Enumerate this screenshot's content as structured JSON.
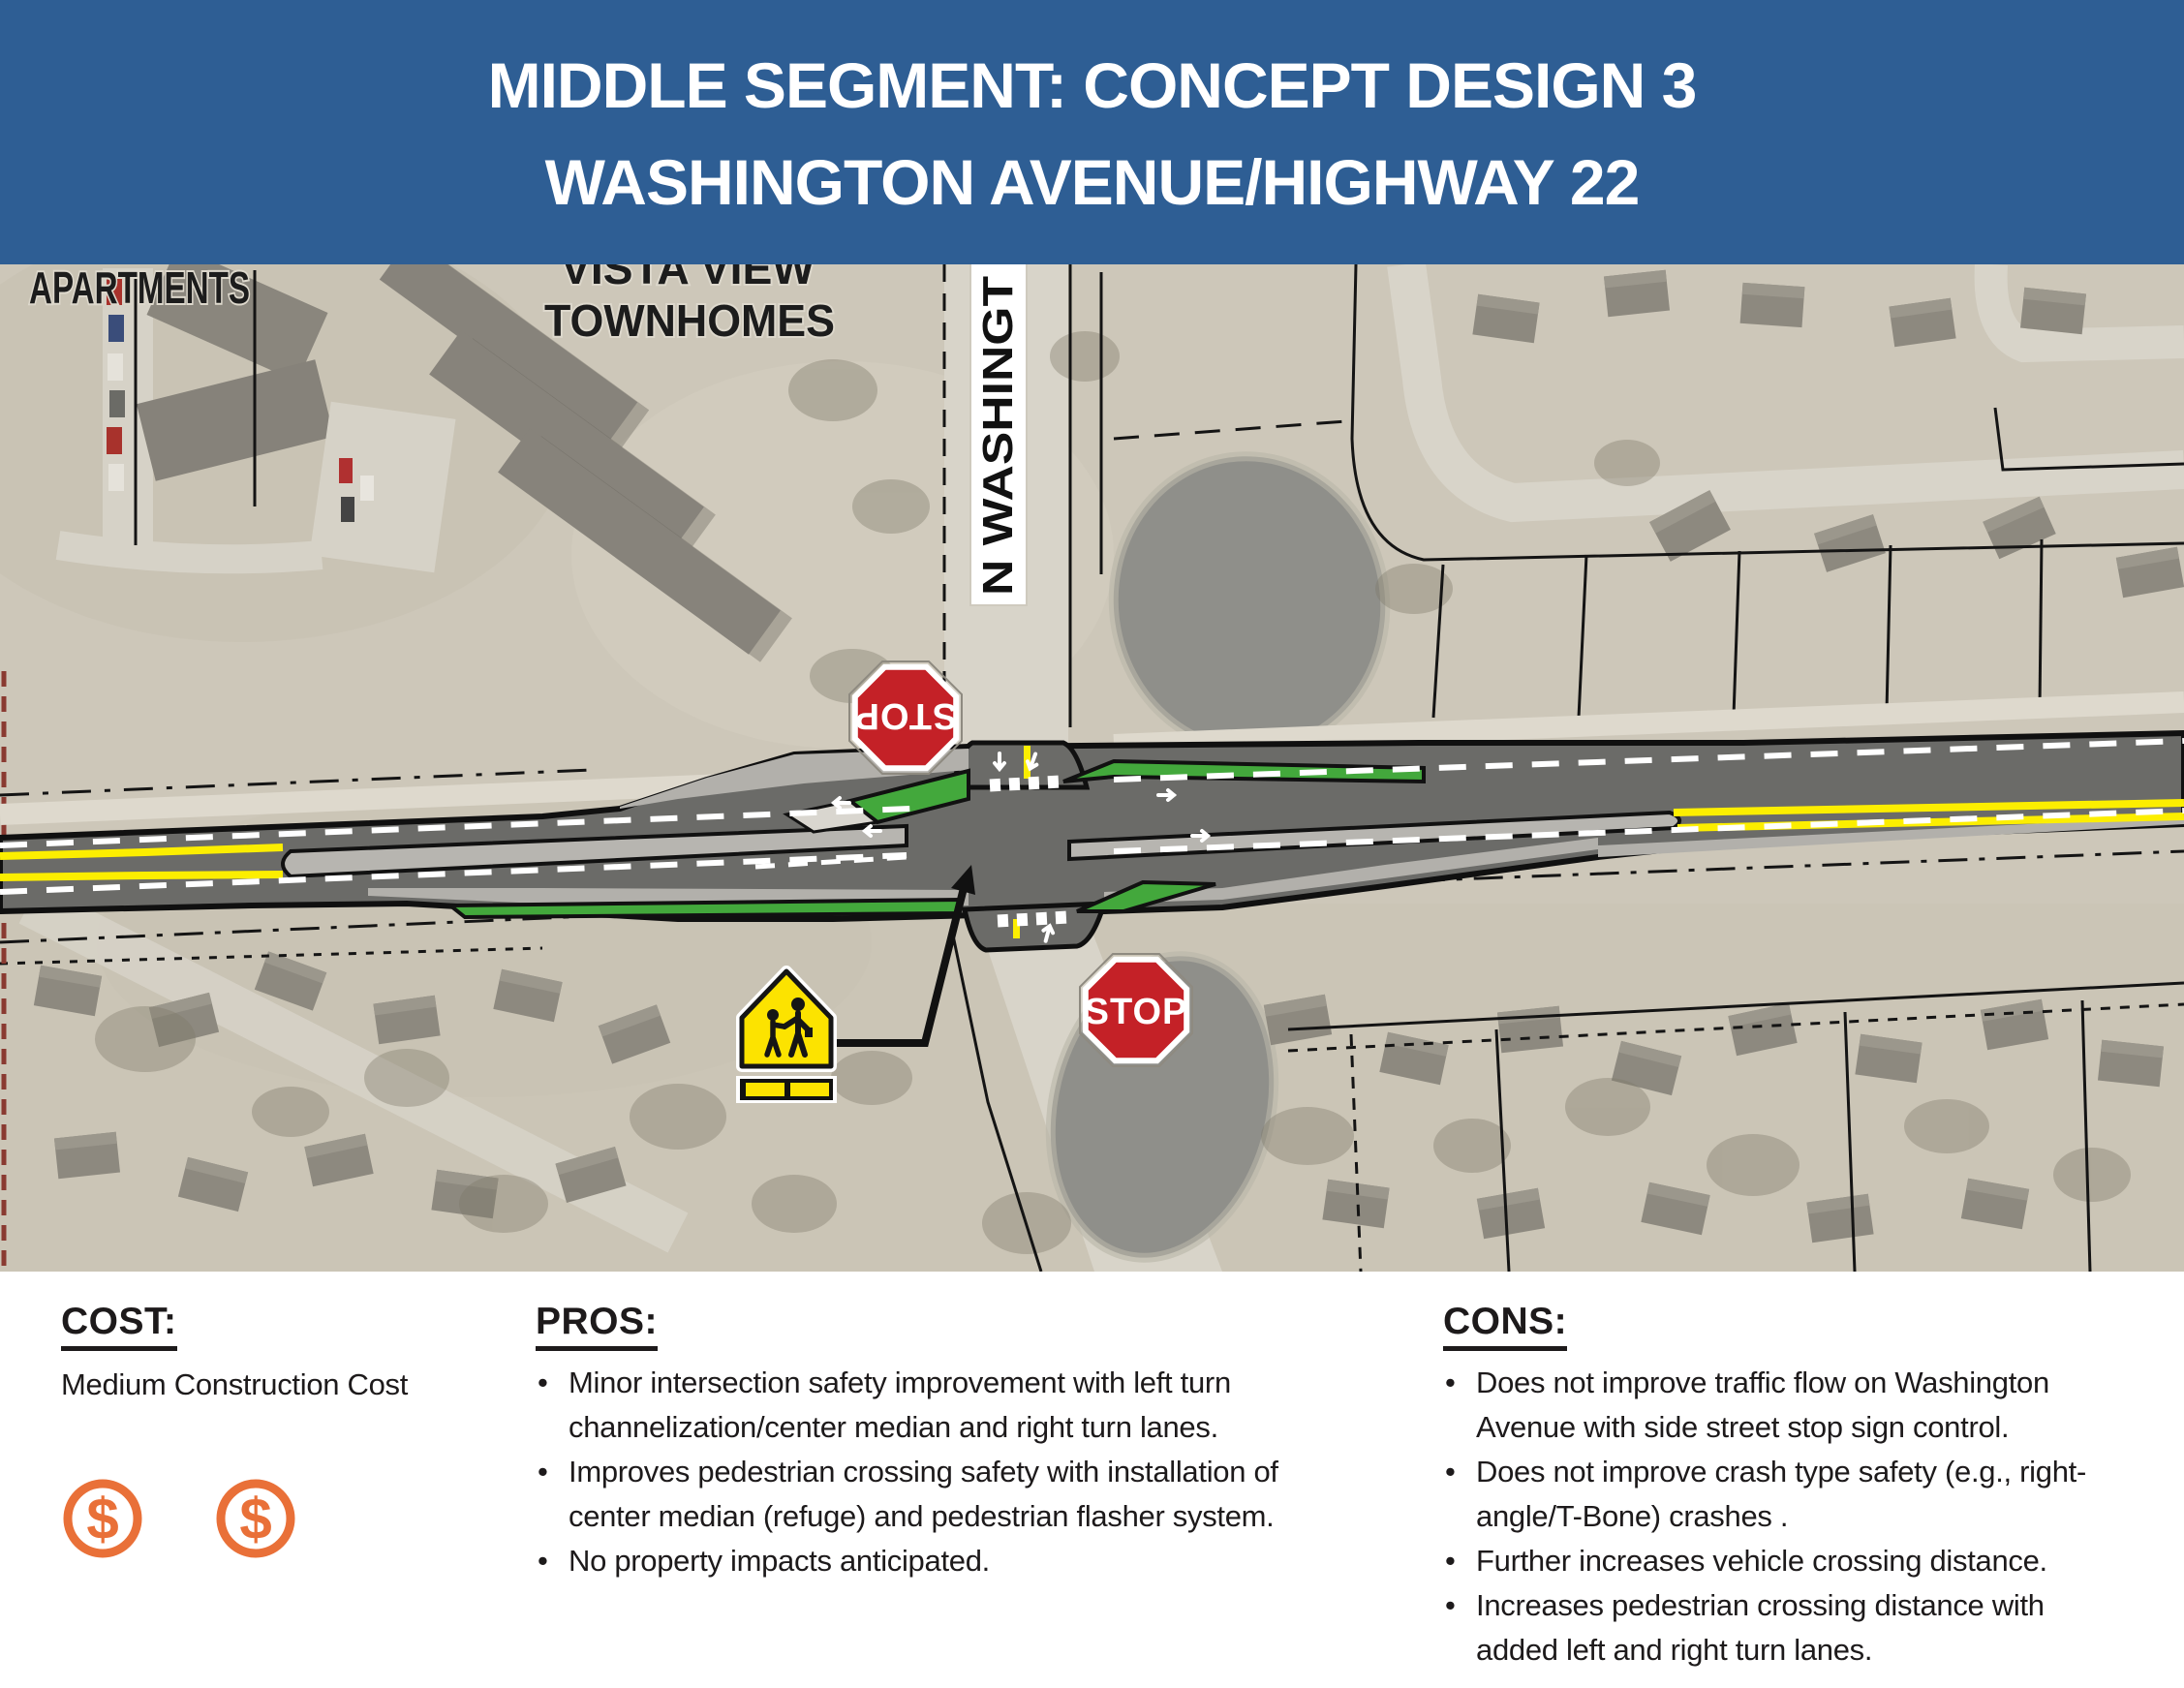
{
  "header": {
    "line1": "MIDDLE SEGMENT: CONCEPT DESIGN 3",
    "line2": "WASHINGTON AVENUE/HIGHWAY 22"
  },
  "map": {
    "labels": {
      "apartments": "APARTMENTS",
      "townhomes_line1": "VISTA VIEW",
      "townhomes_line2": "TOWNHOMES",
      "street_name_vertical": "N WASHINGT"
    },
    "signs": {
      "stop_north": "STOP",
      "stop_south": "STOP"
    }
  },
  "cost": {
    "heading": "COST:",
    "text": "Medium Construction Cost",
    "dollar_symbol": "$",
    "dollar_count": 2
  },
  "pros": {
    "heading": "PROS:",
    "items": [
      "Minor intersection safety improvement with left turn channelization/center median and right turn lanes.",
      "Improves pedestrian crossing safety with installation of center median (refuge) and pedestrian flasher system.",
      "No property impacts anticipated."
    ]
  },
  "cons": {
    "heading": "CONS:",
    "items": [
      "Does not improve traffic flow on Washington Avenue with side street stop sign control.",
      "Does not improve crash type safety (e.g., right-angle/T-Bone) crashes .",
      "Further increases vehicle crossing distance.",
      "Increases pedestrian crossing distance with added left and right turn lanes."
    ]
  },
  "colors": {
    "header_bg": "#2e5e94",
    "island_green": "#43a83c",
    "road_yellow": "#fcee00",
    "stop_sign_red": "#c42127",
    "school_sign_yellow": "#fce300",
    "dollar_orange": "#e97038"
  }
}
